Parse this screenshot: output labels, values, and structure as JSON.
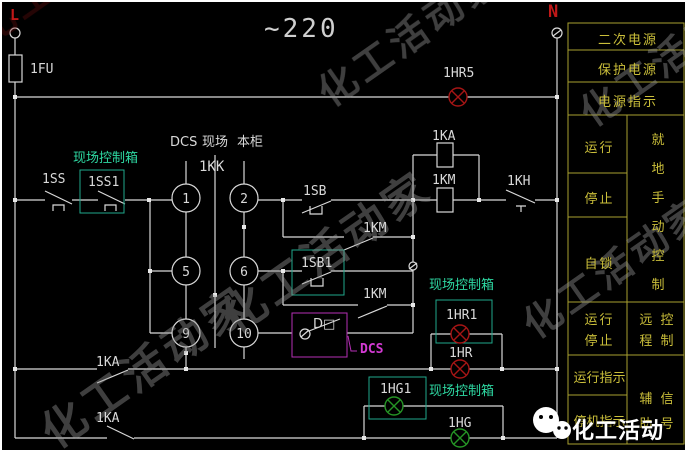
{
  "power": {
    "phase_line": "L",
    "phase_neutral": "N",
    "voltage": "~220",
    "fuse": "1FU",
    "power_lamp": "1HR5"
  },
  "selector": {
    "name": "1KK",
    "positions": [
      "DCS",
      "现场",
      "本柜"
    ],
    "contacts": [
      "1",
      "2",
      "5",
      "6",
      "9",
      "10"
    ]
  },
  "devices": {
    "stop_panel": "1SS",
    "stop_field": "1SS1",
    "start_panel": "1SB",
    "start_field": "1SB1",
    "seal_in_contact_1": "1KM",
    "seal_in_contact_2": "1KM",
    "relay_coil": "1KA",
    "contactor_coil": "1KM",
    "thermal_contact": "1KH",
    "dcs_contact": "D□",
    "dcs_label": "DCS",
    "run_lamp_field": "1HR1",
    "run_lamp_panel": "1HR",
    "ka_contact_1": "1KA",
    "ka_contact_2": "1KA",
    "stop_lamp_field": "1HG1",
    "stop_lamp_panel": "1HG",
    "field_box_label_1": "现场控制箱",
    "field_box_label_2": "现场控制箱",
    "field_box_label_3": "现场控制箱"
  },
  "table": {
    "secondary_power": "二次电源",
    "protection_power": "保护电源",
    "power_indication": "电源指示",
    "run": "运行",
    "stop": "停止",
    "self_lock": "自锁",
    "local_manual_control": "就地手动控制",
    "run_stop": [
      "运行",
      "停止"
    ],
    "remote_control": [
      "远 控",
      "程 制"
    ],
    "run_indication": "运行指示",
    "stop_indication": "停机指示",
    "aux_signal": [
      "辅 信",
      "助 号"
    ]
  },
  "watermark": {
    "text": "化工活动家",
    "wechat_text": "化工活动家"
  },
  "colors": {
    "wire": "#d9d9d9",
    "green_box": "#1fa98b",
    "magenta_box": "#b62fb6",
    "red_lamp": "#a51515",
    "green_lamp": "#259425",
    "table_olive": "#a8a030"
  }
}
